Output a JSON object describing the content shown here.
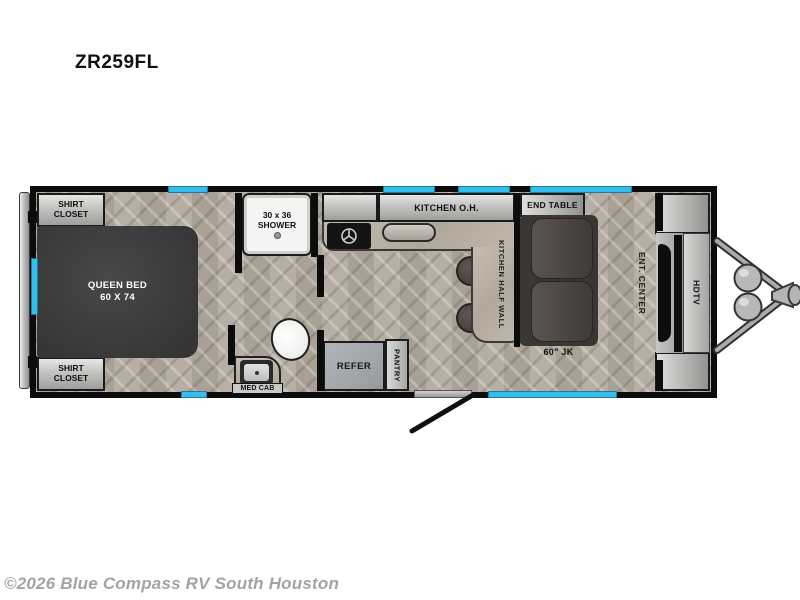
{
  "title": "ZR259FL",
  "footer": {
    "copyright": "©2026 Blue Compass RV South Houston"
  },
  "colors": {
    "window_accent": "#35bdee",
    "wall": "#0c0c0c",
    "floor_base": "#b2a99e",
    "bed_fill": "#3d3d3d",
    "sofa_fill": "#4a4744"
  },
  "floorplan": {
    "bedroom": {
      "shirt_closet_top": "SHIRT CLOSET",
      "shirt_closet_bottom": "SHIRT CLOSET",
      "queen_bed_name": "QUEEN BED",
      "queen_bed_size": "60 X 74"
    },
    "bathroom": {
      "shower_size": "30 x 36",
      "shower_name": "SHOWER",
      "med_cab": "MED CAB"
    },
    "kitchen": {
      "overhead": "KITCHEN O.H.",
      "half_wall": "KITCHEN HALF WALL",
      "refer": "REFER",
      "pantry": "PANTRY"
    },
    "living": {
      "end_table": "END TABLE",
      "sofa": "60\" JK",
      "ent_center": "ENT. CENTER",
      "hdtv": "HDTV"
    }
  }
}
